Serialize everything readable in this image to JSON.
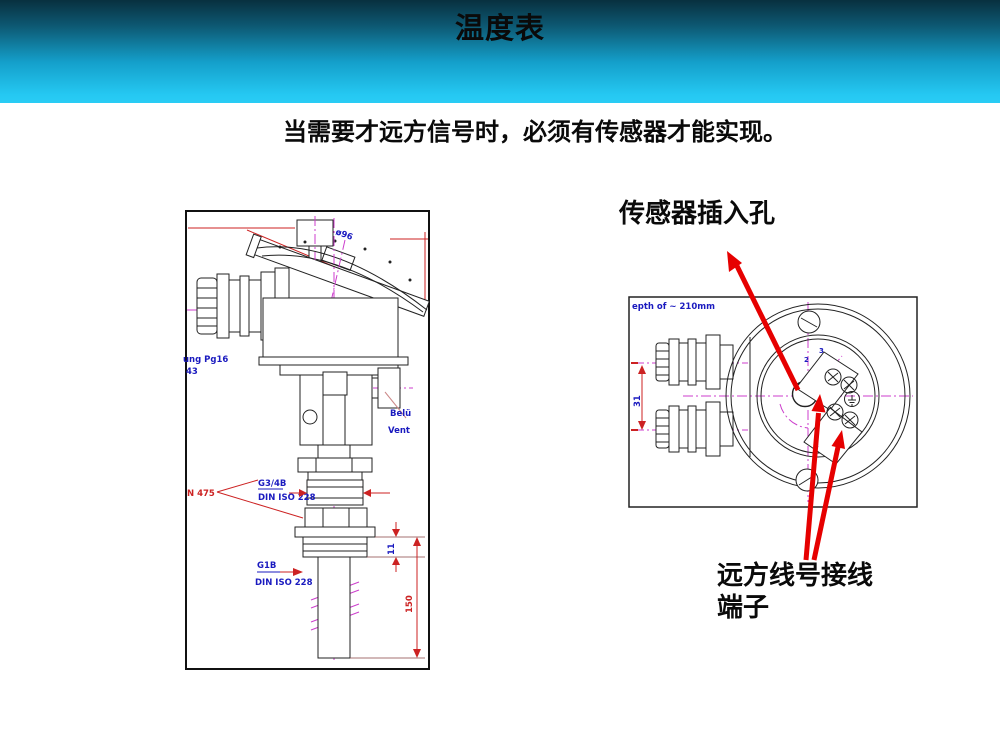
{
  "slide": {
    "title": "温度表",
    "subtitle": "当需要才远方信号时，必须有传感器才能实现。"
  },
  "labels": {
    "sensor_hole": "传感器插入孔",
    "terminal_line1": "远方线号接线",
    "terminal_line2": "端子"
  },
  "left_drawing": {
    "diameter": "ø96",
    "gland_line1": "ung Pg16",
    "gland_line2": "43",
    "vent_line1": "Belü",
    "vent_line2": "Vent",
    "din475": "N 475",
    "thread_upper": "G3/4B",
    "thread_upper_std": "DIN ISO 228",
    "thread_lower": "G1B",
    "thread_lower_std": "DIN ISO 228",
    "dim_neck": "11",
    "dim_probe": "150"
  },
  "right_drawing": {
    "depth_note": "epth of ~ 210mm",
    "dim_glands": "31",
    "terminal_no_2": "2",
    "terminal_no_3": "3",
    "terminal_no_3b": "3"
  },
  "colors": {
    "header_top": "#08303f",
    "header_bottom": "#29ccf5",
    "arrow_red": "#e60000",
    "centerline_magenta": "#cc3ecc",
    "dimension_red": "#cc2222",
    "annotation_blue": "#1a1abf"
  }
}
